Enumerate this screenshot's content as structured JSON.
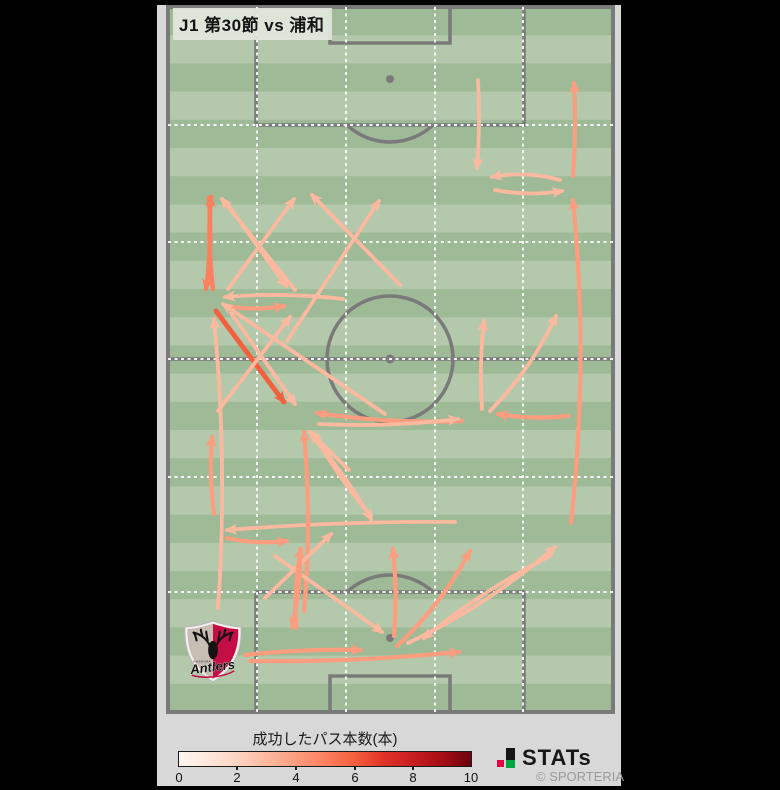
{
  "window": {
    "width": 780,
    "height": 790
  },
  "header": {
    "title": "J1 第30節 vs 浦和"
  },
  "legend": {
    "title": "成功したパス本数(本)",
    "tick_labels": [
      "0",
      "2",
      "4",
      "6",
      "8",
      "10"
    ],
    "min": 0,
    "max": 10
  },
  "branding": {
    "stats_text": "STATs",
    "copyright": "© SPORTERIA"
  },
  "team_logo": {
    "team": "Kashima Antlers",
    "script_text": "Antlers",
    "small_text": "KASHIMA"
  },
  "chart_data": {
    "type": "pass_flow_map",
    "title": "J1 第30節 vs 浦和",
    "colorbar_label": "成功したパス本数(本)",
    "colorbar_range": [
      0,
      10
    ],
    "colorbar_ticks": [
      0,
      2,
      4,
      6,
      8,
      10
    ],
    "colormap_stops": [
      "#fff5f0",
      "#fee9dc",
      "#fdd4c2",
      "#fcb99f",
      "#fc9d7f",
      "#fb8060",
      "#f4603e",
      "#e13327",
      "#c81e22",
      "#a50f15",
      "#6d010d"
    ],
    "pitch": {
      "x": 168,
      "y": 7,
      "width": 445,
      "height": 705,
      "stripe_count": 25,
      "stripe_dark": "#9eba96",
      "stripe_light": "#b4c9ab",
      "line_color": "#7a7a7a",
      "grid_color": "#ffffff",
      "grid_cols": [
        257,
        346,
        435,
        523
      ],
      "grid_rows": [
        125,
        242,
        359,
        477,
        592
      ]
    },
    "arrows": [
      {
        "x1": 478,
        "y1": 80,
        "x2": 477,
        "y2": 168,
        "bow": 3,
        "passes": 3
      },
      {
        "x1": 573,
        "y1": 176,
        "x2": 574,
        "y2": 83,
        "bow": -3,
        "passes": 4
      },
      {
        "x1": 560,
        "y1": 180,
        "x2": 492,
        "y2": 177,
        "bow": -8,
        "passes": 3
      },
      {
        "x1": 495,
        "y1": 190,
        "x2": 562,
        "y2": 191,
        "bow": -6,
        "passes": 3
      },
      {
        "x1": 571,
        "y1": 523,
        "x2": 573,
        "y2": 200,
        "bow": -17,
        "passes": 4
      },
      {
        "x1": 213,
        "y1": 289,
        "x2": 211,
        "y2": 197,
        "bow": 5,
        "passes": 5
      },
      {
        "x1": 209,
        "y1": 198,
        "x2": 206,
        "y2": 289,
        "bow": 5,
        "passes": 5
      },
      {
        "x1": 295,
        "y1": 290,
        "x2": 222,
        "y2": 199,
        "bow": 0,
        "passes": 3
      },
      {
        "x1": 226,
        "y1": 202,
        "x2": 286,
        "y2": 286,
        "bow": 0,
        "passes": 3
      },
      {
        "x1": 228,
        "y1": 289,
        "x2": 294,
        "y2": 199,
        "bow": 0,
        "passes": 3
      },
      {
        "x1": 400,
        "y1": 285,
        "x2": 312,
        "y2": 195,
        "bow": 0,
        "passes": 3
      },
      {
        "x1": 287,
        "y1": 341,
        "x2": 379,
        "y2": 201,
        "bow": 0,
        "passes": 3
      },
      {
        "x1": 343,
        "y1": 299,
        "x2": 225,
        "y2": 297,
        "bow": -6,
        "passes": 3
      },
      {
        "x1": 226,
        "y1": 306,
        "x2": 284,
        "y2": 306,
        "bow": -5,
        "passes": 4
      },
      {
        "x1": 216,
        "y1": 311,
        "x2": 284,
        "y2": 402,
        "bow": 0,
        "passes": 6
      },
      {
        "x1": 231,
        "y1": 313,
        "x2": 295,
        "y2": 404,
        "bow": 0,
        "passes": 3
      },
      {
        "x1": 218,
        "y1": 411,
        "x2": 290,
        "y2": 317,
        "bow": 0,
        "passes": 3
      },
      {
        "x1": 385,
        "y1": 414,
        "x2": 223,
        "y2": 304,
        "bow": 0,
        "passes": 3
      },
      {
        "x1": 218,
        "y1": 608,
        "x2": 214,
        "y2": 319,
        "bow": -12,
        "passes": 3
      },
      {
        "x1": 214,
        "y1": 514,
        "x2": 212,
        "y2": 437,
        "bow": 4,
        "passes": 4
      },
      {
        "x1": 455,
        "y1": 522,
        "x2": 227,
        "y2": 530,
        "bow": -5,
        "passes": 3
      },
      {
        "x1": 227,
        "y1": 538,
        "x2": 287,
        "y2": 541,
        "bow": -5,
        "passes": 4
      },
      {
        "x1": 312,
        "y1": 436,
        "x2": 371,
        "y2": 519,
        "bow": 5,
        "passes": 3
      },
      {
        "x1": 371,
        "y1": 516,
        "x2": 313,
        "y2": 433,
        "bow": 5,
        "passes": 3
      },
      {
        "x1": 304,
        "y1": 611,
        "x2": 304,
        "y2": 432,
        "bow": -8,
        "passes": 4
      },
      {
        "x1": 349,
        "y1": 470,
        "x2": 310,
        "y2": 432,
        "bow": 0,
        "passes": 3
      },
      {
        "x1": 265,
        "y1": 598,
        "x2": 331,
        "y2": 534,
        "bow": 0,
        "passes": 3
      },
      {
        "x1": 275,
        "y1": 556,
        "x2": 382,
        "y2": 632,
        "bow": 0,
        "passes": 3
      },
      {
        "x1": 296,
        "y1": 628,
        "x2": 301,
        "y2": 549,
        "bow": 5,
        "passes": 4
      },
      {
        "x1": 300,
        "y1": 549,
        "x2": 292,
        "y2": 627,
        "bow": 5,
        "passes": 4
      },
      {
        "x1": 245,
        "y1": 655,
        "x2": 361,
        "y2": 650,
        "bow": 4,
        "passes": 4
      },
      {
        "x1": 250,
        "y1": 661,
        "x2": 459,
        "y2": 652,
        "bow": -6,
        "passes": 4
      },
      {
        "x1": 394,
        "y1": 636,
        "x2": 393,
        "y2": 549,
        "bow": -4,
        "passes": 4
      },
      {
        "x1": 397,
        "y1": 646,
        "x2": 470,
        "y2": 551,
        "bow": -10,
        "passes": 4
      },
      {
        "x1": 408,
        "y1": 643,
        "x2": 555,
        "y2": 547,
        "bow": -12,
        "passes": 3
      },
      {
        "x1": 550,
        "y1": 556,
        "x2": 424,
        "y2": 638,
        "bow": -8,
        "passes": 3
      },
      {
        "x1": 482,
        "y1": 409,
        "x2": 484,
        "y2": 321,
        "bow": 4,
        "passes": 3
      },
      {
        "x1": 490,
        "y1": 411,
        "x2": 556,
        "y2": 316,
        "bow": -10,
        "passes": 3
      },
      {
        "x1": 462,
        "y1": 421,
        "x2": 317,
        "y2": 413,
        "bow": 7,
        "passes": 4
      },
      {
        "x1": 319,
        "y1": 424,
        "x2": 458,
        "y2": 419,
        "bow": -6,
        "passes": 3
      },
      {
        "x1": 568,
        "y1": 416,
        "x2": 498,
        "y2": 414,
        "bow": 5,
        "passes": 4
      }
    ]
  }
}
